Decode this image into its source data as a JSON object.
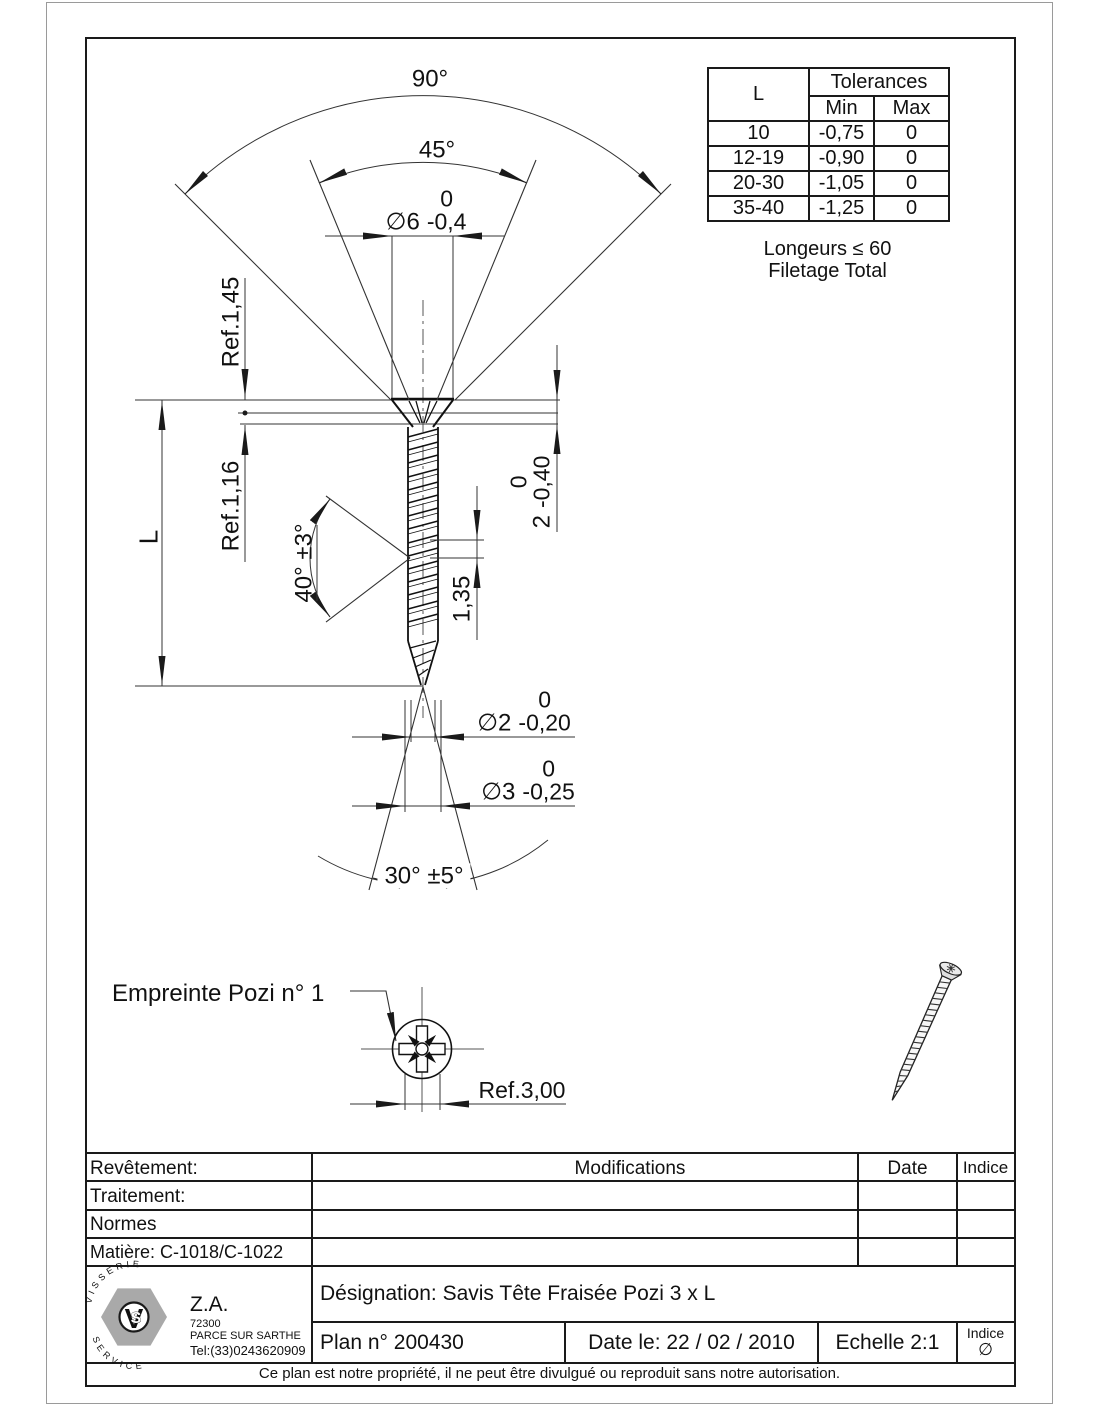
{
  "drawing": {
    "dims": {
      "angle90": "90°",
      "angle45": "45°",
      "dia6": {
        "prefix": "∅6",
        "upper": "0",
        "lower": "-0,4"
      },
      "ref_145": "Ref.1,45",
      "ref_116": "Ref.1,16",
      "length": "L",
      "thread_angle": "40° ±3°",
      "head_depth": {
        "prefix": "2",
        "upper": "0",
        "lower": "-0,40"
      },
      "pitch": "1,35",
      "dia2": {
        "prefix": "∅2",
        "upper": "0",
        "lower": "-0,20"
      },
      "dia3": {
        "prefix": "∅3",
        "upper": "0",
        "lower": "-0,25"
      },
      "tip_angle": "30° ±5°",
      "recess_label": "Empreinte Pozi n° 1",
      "recess_ref": "Ref.3,00"
    },
    "tolerance_table": {
      "col_l": "L",
      "col_tolerances": "Tolerances",
      "col_min": "Min",
      "col_max": "Max",
      "rows": [
        [
          "10",
          "-0,75",
          "0"
        ],
        [
          "12-19",
          "-0,90",
          "0"
        ],
        [
          "20-30",
          "-1,05",
          "0"
        ],
        [
          "35-40",
          "-1,25",
          "0"
        ]
      ],
      "note1": "Longeurs ≤ 60",
      "note2": "Filetage Total"
    }
  },
  "title_block": {
    "revetement": "Revêtement:",
    "traitement": "Traitement:",
    "normes": "Normes",
    "matiere": "Matière: C-1018/C-1022",
    "modifications": "Modifications",
    "date_col": "Date",
    "indice_col": "Indice",
    "designation": "Désignation: Savis Tête Fraisée Pozi 3 x L",
    "plan": "Plan n° 200430",
    "date_le": "Date le: 22 / 02 / 2010",
    "echelle": "Echelle 2:1",
    "indice_label": "Indice",
    "indice_value": "∅",
    "company": {
      "za": "Z.A.",
      "zip": "72300",
      "city": "PARCE SUR SARTHE",
      "tel": "Tel:(33)0243620909",
      "logo_top": "VISSERIE",
      "logo_bottom": "SERVICE",
      "logo_v": "V",
      "logo_s": "S"
    },
    "footer_note": "Ce plan est notre propriété, il ne peut être divulgué ou reproduit sans notre autorisation.",
    "colors": {
      "line": "#1a1a1a",
      "logo_gray": "#a9a9a9"
    }
  }
}
